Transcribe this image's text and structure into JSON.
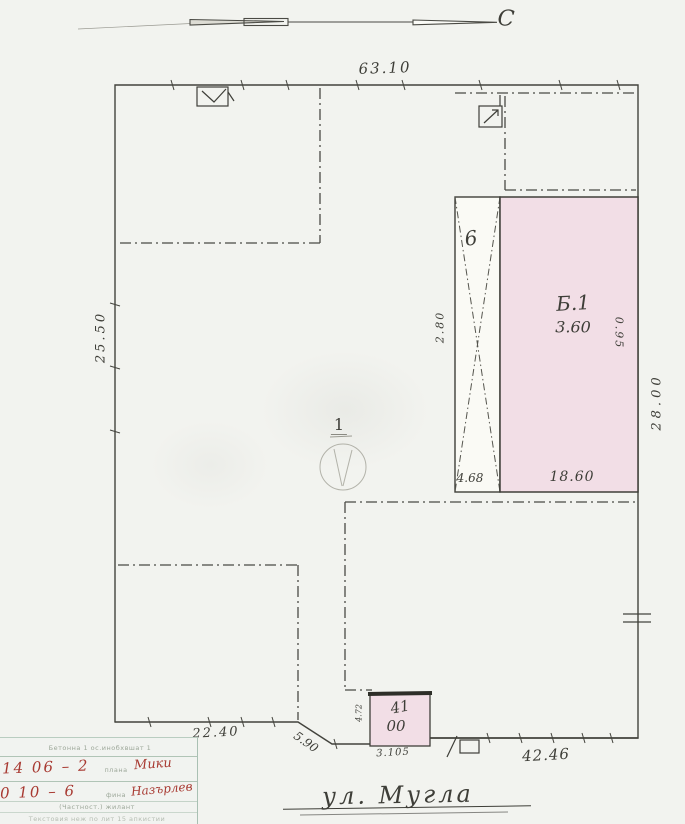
{
  "north": {
    "label": "С"
  },
  "plot": {
    "number_label": "1",
    "dim_top": "63.10",
    "dim_left": "25.50",
    "dim_right": "28.00",
    "dim_bottom_left": "22.40",
    "dim_bottom_diag": "5.90",
    "dim_bottom_right": "42.46"
  },
  "buildings": {
    "b6": {
      "label": "6",
      "dim_left": "2.80",
      "dim_bottom": "4.68"
    },
    "b1": {
      "label": "Б.1",
      "height": "3.60",
      "dim_bottom": "18.60",
      "dim_right": "0.95"
    },
    "small": {
      "label_line1": "41",
      "label_line2": "00",
      "dim_left": "4.72",
      "dim_bottom": "3.105"
    }
  },
  "caption": {
    "text": "ул. Мугла"
  },
  "stamp": {
    "header": "Бетонна 1 ос.инобхвшат 1",
    "row1_left": "14 06 – 2",
    "row1_mid": "плана",
    "row1_right": "Мики",
    "row2_left": "0 10 – 6",
    "row2_mid": "фина",
    "row2_right": "Назърлев",
    "row3": "(Частност.)  жилант",
    "row4": "Текстовия неж по лит 15 апкистии"
  },
  "colors": {
    "paper": "#f2f3ef",
    "ink": "#43433d",
    "building_fill_pink": "#f2dee6",
    "handwriting_red": "#a83a32",
    "stamp_line": "#b0c4b6"
  }
}
